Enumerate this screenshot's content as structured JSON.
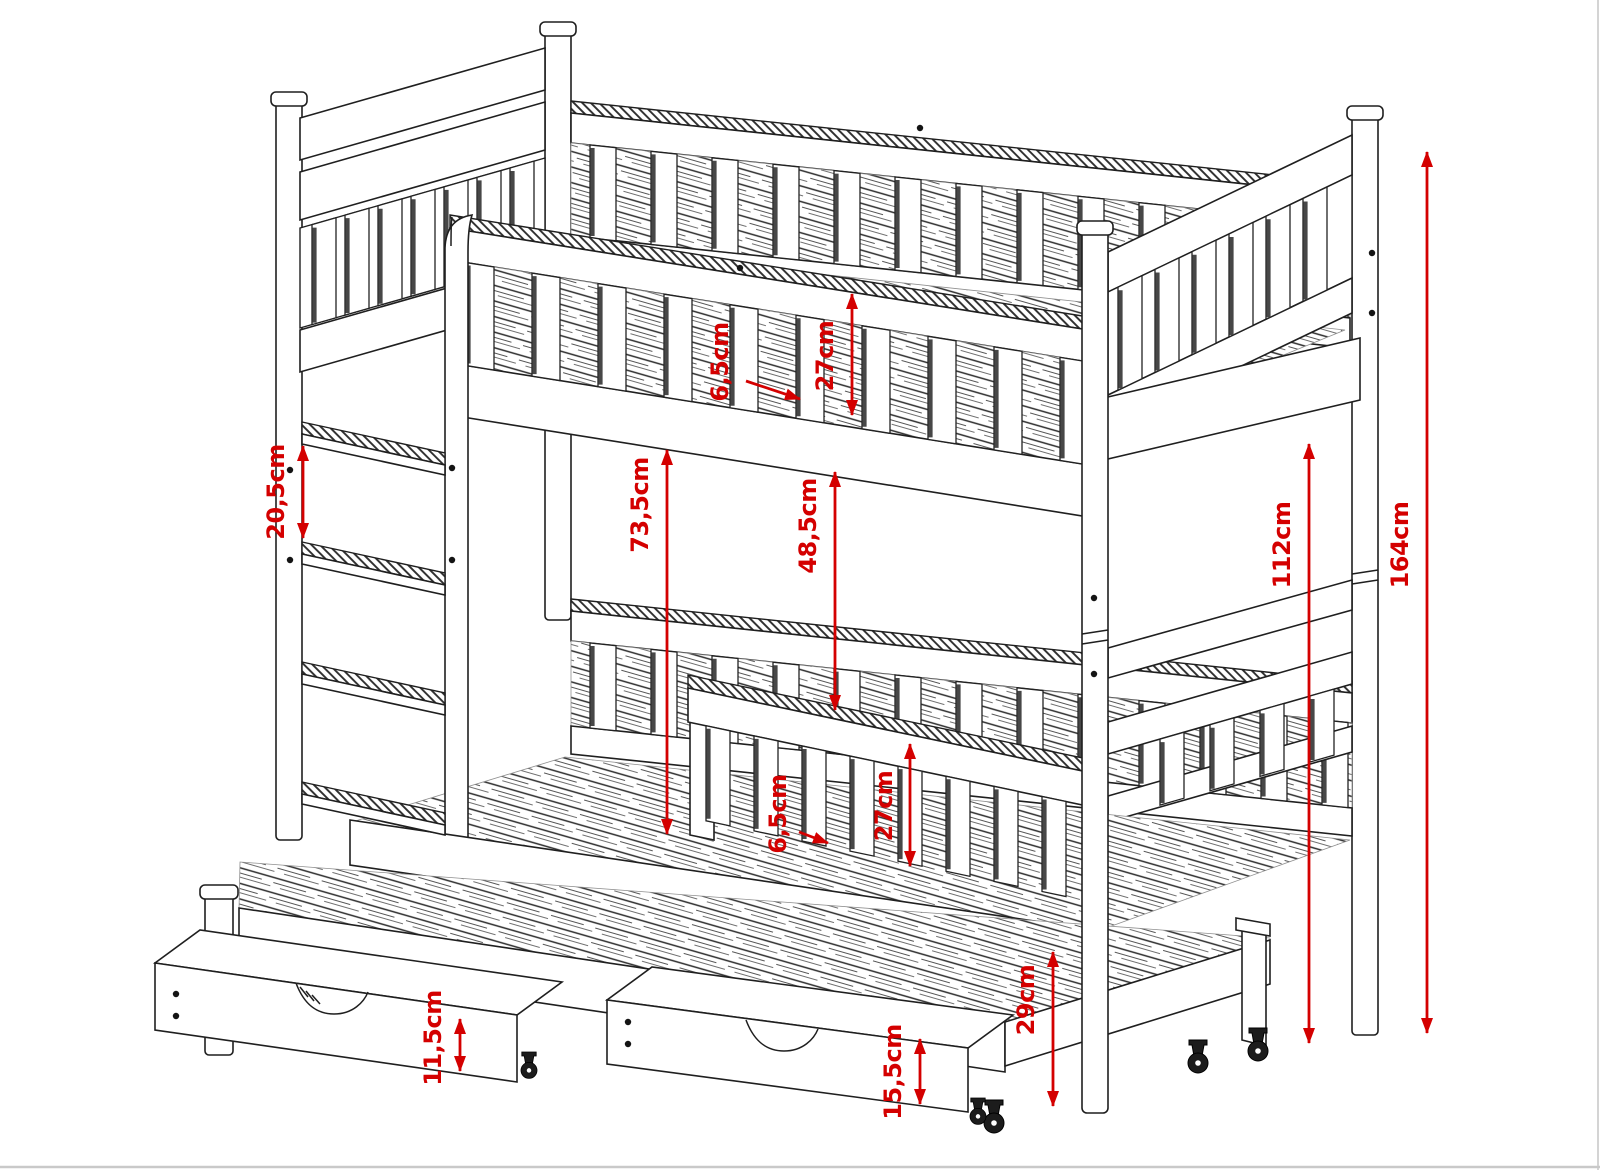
{
  "palette": {
    "background": "#ffffff",
    "line": "#1f1f1f",
    "dimension_red": "#d40000"
  },
  "annotations": {
    "dimensions": [
      {
        "label": "6,5cm",
        "type": "pointer",
        "text_x": 728,
        "text_y": 362,
        "x1": 746,
        "y1": 381,
        "x2": 800,
        "y2": 399
      },
      {
        "label": "27cm",
        "type": "extent",
        "x": 852,
        "y1": 292,
        "y2": 417,
        "text_x": 833,
        "text_y": 356
      },
      {
        "label": "20,5cm",
        "type": "extent",
        "x": 303,
        "y1": 444,
        "y2": 540,
        "text_x": 284,
        "text_y": 492
      },
      {
        "label": "73,5cm",
        "type": "extent",
        "x": 667,
        "y1": 448,
        "y2": 836,
        "text_x": 648,
        "text_y": 505
      },
      {
        "label": "48,5cm",
        "type": "extent",
        "x": 835,
        "y1": 470,
        "y2": 712,
        "text_x": 816,
        "text_y": 526
      },
      {
        "label": "112cm",
        "type": "extent",
        "x": 1309,
        "y1": 442,
        "y2": 1045,
        "text_x": 1290,
        "text_y": 545
      },
      {
        "label": "164cm",
        "type": "extent",
        "x": 1427,
        "y1": 150,
        "y2": 1035,
        "text_x": 1408,
        "text_y": 545
      },
      {
        "label": "6,5cm",
        "type": "pointer",
        "text_x": 786,
        "text_y": 814,
        "x1": 799,
        "y1": 832,
        "x2": 828,
        "y2": 843
      },
      {
        "label": "27cm",
        "type": "extent",
        "x": 910,
        "y1": 742,
        "y2": 868,
        "text_x": 892,
        "text_y": 806
      },
      {
        "label": "29cm",
        "type": "extent",
        "x": 1053,
        "y1": 950,
        "y2": 1108,
        "text_x": 1034,
        "text_y": 1000
      },
      {
        "label": "11,5cm",
        "type": "extent",
        "x": 460,
        "y1": 1017,
        "y2": 1073,
        "text_x": 441,
        "text_y": 1038
      },
      {
        "label": "15,5cm",
        "type": "extent",
        "x": 920,
        "y1": 1037,
        "y2": 1106,
        "text_x": 901,
        "text_y": 1072
      }
    ]
  }
}
